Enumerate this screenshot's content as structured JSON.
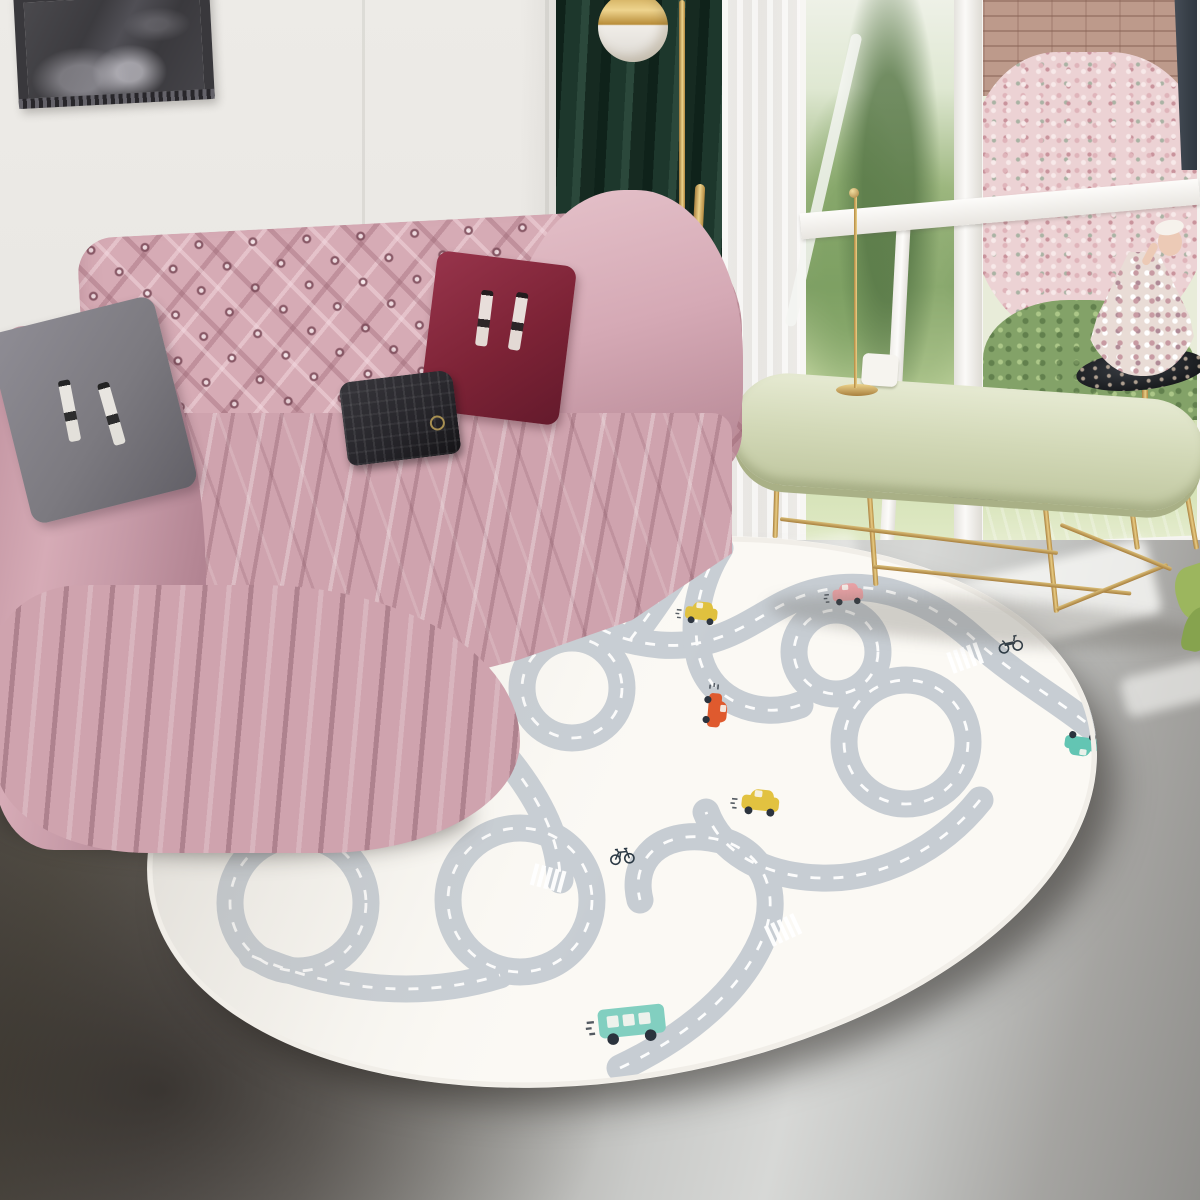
{
  "scene": {
    "description": "Living room product photo: pink tufted chesterfield sofa with velvet throw, figure-print cushions and black clutch, dark green curtain with brass globe lamp, garden windows, brass oval coffee table with candlestick and doll floral centerpiece, and an oval kids road-map play rug on a concrete floor",
    "wall": {
      "label": "white panelled wall"
    },
    "artwork": {
      "label": "dark framed wall art"
    },
    "lamp": {
      "label": "brass globe floor lamp"
    },
    "curtain": {
      "label": "dark green velvet curtain"
    },
    "sheer": {
      "label": "white sheer curtain"
    },
    "window": {
      "label": "garden window with white mullions",
      "garden": [
        "green shrubs",
        "pink blossom bush",
        "brick wall",
        "lawn",
        "tree trunk"
      ]
    },
    "sofa": {
      "label": "pink tufted chesterfield sofa with velvet throw"
    },
    "pillows": [
      {
        "label": "grey figure-print cushion"
      },
      {
        "label": "burgundy figure-print cushion"
      }
    ],
    "bag": {
      "label": "black quilted clutch"
    },
    "table": {
      "label": "oval brass-leg coffee table",
      "items": [
        "white candle box",
        "brass candlestick",
        "gold disc tray"
      ]
    },
    "centerpiece": {
      "label": "doll with floral gown on black tray stand"
    },
    "plant": {
      "label": "green leaves at window"
    },
    "floor": {
      "label": "grey concrete floor with window light streaks"
    },
    "rug": {
      "label": "oval kids road play rug with cars"
    }
  },
  "colors": {
    "wall": "#eae8e4",
    "frame-dark": "#39383c",
    "curtain": "#1d372c",
    "sheer": "#f2f1ee",
    "window-frame": "#f7f6f3",
    "garden-green": "#83a268",
    "grass": "#d6e3b8",
    "blossom": "#ecd2d4",
    "brick": "#bd9a8b",
    "trunk": "#3a424b",
    "sofa-pink": "#d6abb5",
    "drape-pink": "#cfa3ae",
    "pillow-gray": "#7c7a80",
    "pillow-burgundy": "#7d2336",
    "clutch-black": "#26252a",
    "gold": "#c79e4f",
    "table-top": "#d3d9b8",
    "floor-dark": "#4a4540",
    "floor-light": "#d7d8d6",
    "rug-cream": "#fbf9f4",
    "road-gray": "#c7cdd3",
    "wheel-dark": "#2b333d",
    "tray-black": "#17191c",
    "dress-cream": "#e9dcd6",
    "skin": "#eccab6"
  },
  "rug": {
    "vehicles": [
      {
        "type": "car",
        "color": "#5fc3b1",
        "x": 548,
        "y": 573,
        "rot": -8,
        "scale": 0.95
      },
      {
        "type": "firetruck",
        "color": "#e0502f",
        "x": 436,
        "y": 633,
        "rot": 185,
        "scale": 1.1
      },
      {
        "type": "car",
        "color": "#e0c03c",
        "x": 701,
        "y": 616,
        "rot": 6,
        "scale": 0.95
      },
      {
        "type": "car",
        "color": "#eaa2a6",
        "x": 848,
        "y": 597,
        "rot": -4,
        "scale": 0.9
      },
      {
        "type": "car",
        "color": "#df5a2e",
        "x": 712,
        "y": 710,
        "rot": 95,
        "scale": 1.0
      },
      {
        "type": "car",
        "color": "#efa0a8",
        "x": 452,
        "y": 775,
        "rot": 185,
        "scale": 1.15
      },
      {
        "type": "car",
        "color": "#e2c240",
        "x": 760,
        "y": 806,
        "rot": 6,
        "scale": 1.1
      },
      {
        "type": "motorcycle",
        "color": "#2c3a45",
        "x": 1010,
        "y": 643,
        "rot": -12,
        "scale": 1.0
      },
      {
        "type": "car",
        "color": "#63c5b3",
        "x": 1082,
        "y": 741,
        "rot": 188,
        "scale": 1.0
      },
      {
        "type": "bicycle",
        "color": "#2c3a45",
        "x": 622,
        "y": 855,
        "rot": -6,
        "scale": 1.0
      },
      {
        "type": "bus",
        "color": "#82cfc0",
        "x": 632,
        "y": 1024,
        "rot": -6,
        "scale": 1.45
      },
      {
        "type": "car",
        "color": "#d9bb39",
        "x": 255,
        "y": 803,
        "rot": -28,
        "scale": 1.05
      }
    ],
    "crosswalks": [
      {
        "x": 390,
        "y": 726,
        "rot": -35
      },
      {
        "x": 548,
        "y": 878,
        "rot": 15
      },
      {
        "x": 783,
        "y": 930,
        "rot": -25
      },
      {
        "x": 965,
        "y": 658,
        "rot": -20
      },
      {
        "x": 445,
        "y": 581,
        "rot": 55
      }
    ]
  }
}
